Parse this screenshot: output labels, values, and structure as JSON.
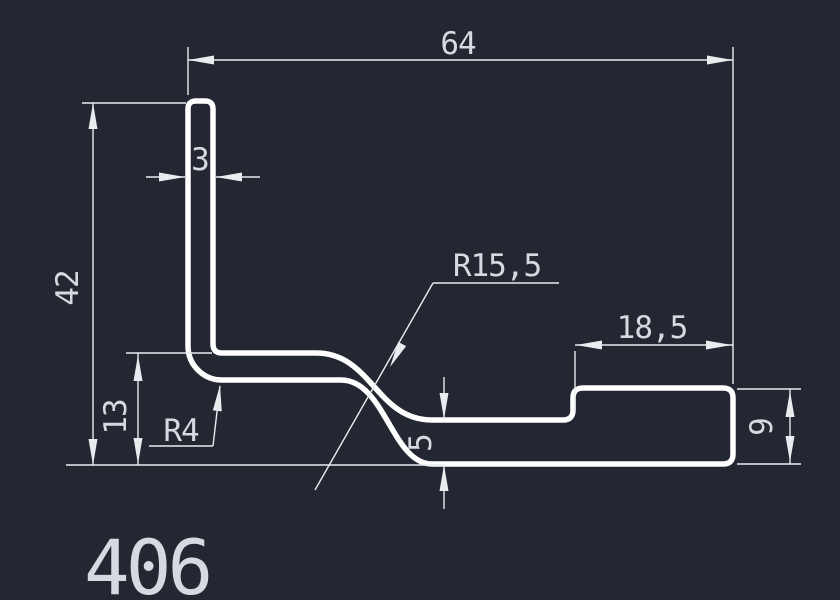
{
  "drawing": {
    "part_number": "406",
    "colors": {
      "background": "#222731",
      "profile_stroke": "#ffffff",
      "dimension_stroke": "#e9ecef",
      "text": "#d6dae0"
    },
    "dimensions": {
      "top_width": "64",
      "leg_thickness": "3",
      "left_height": "42",
      "lower_left_height": "13",
      "bend_radius_small": "R4",
      "bend_radius_large": "R15,5",
      "right_step_length": "18,5",
      "mid_thickness": "5",
      "right_end_height": "9"
    }
  }
}
